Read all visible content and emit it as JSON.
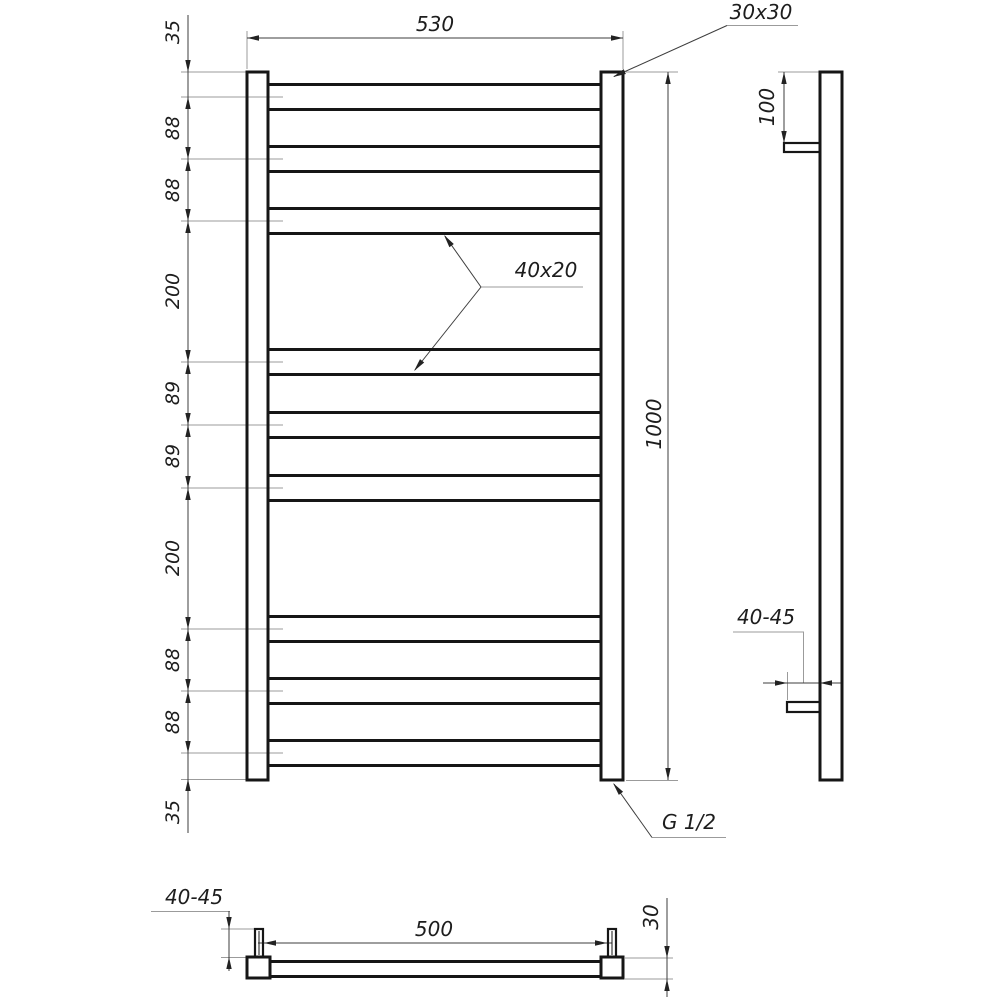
{
  "front_view": {
    "overall_width": "530",
    "overall_height": "1000",
    "post_section": "30x30",
    "rung_section": "40x20",
    "connection_thread": "G 1/2",
    "vertical_chain": [
      "35",
      "88",
      "88",
      "200",
      "89",
      "89",
      "200",
      "88",
      "88",
      "35"
    ]
  },
  "side_view": {
    "top_bracket_offset": "100",
    "wall_clearance": "40-45"
  },
  "bottom_view": {
    "mount_spacing": "500",
    "post_depth": "30",
    "wall_clearance": "40-45"
  },
  "colors": {
    "background": "#ffffff",
    "outline": "#161616",
    "dimension_line": "#3d3d3d",
    "extension_line": "#9b9b9b",
    "text": "#1d1d1d"
  }
}
